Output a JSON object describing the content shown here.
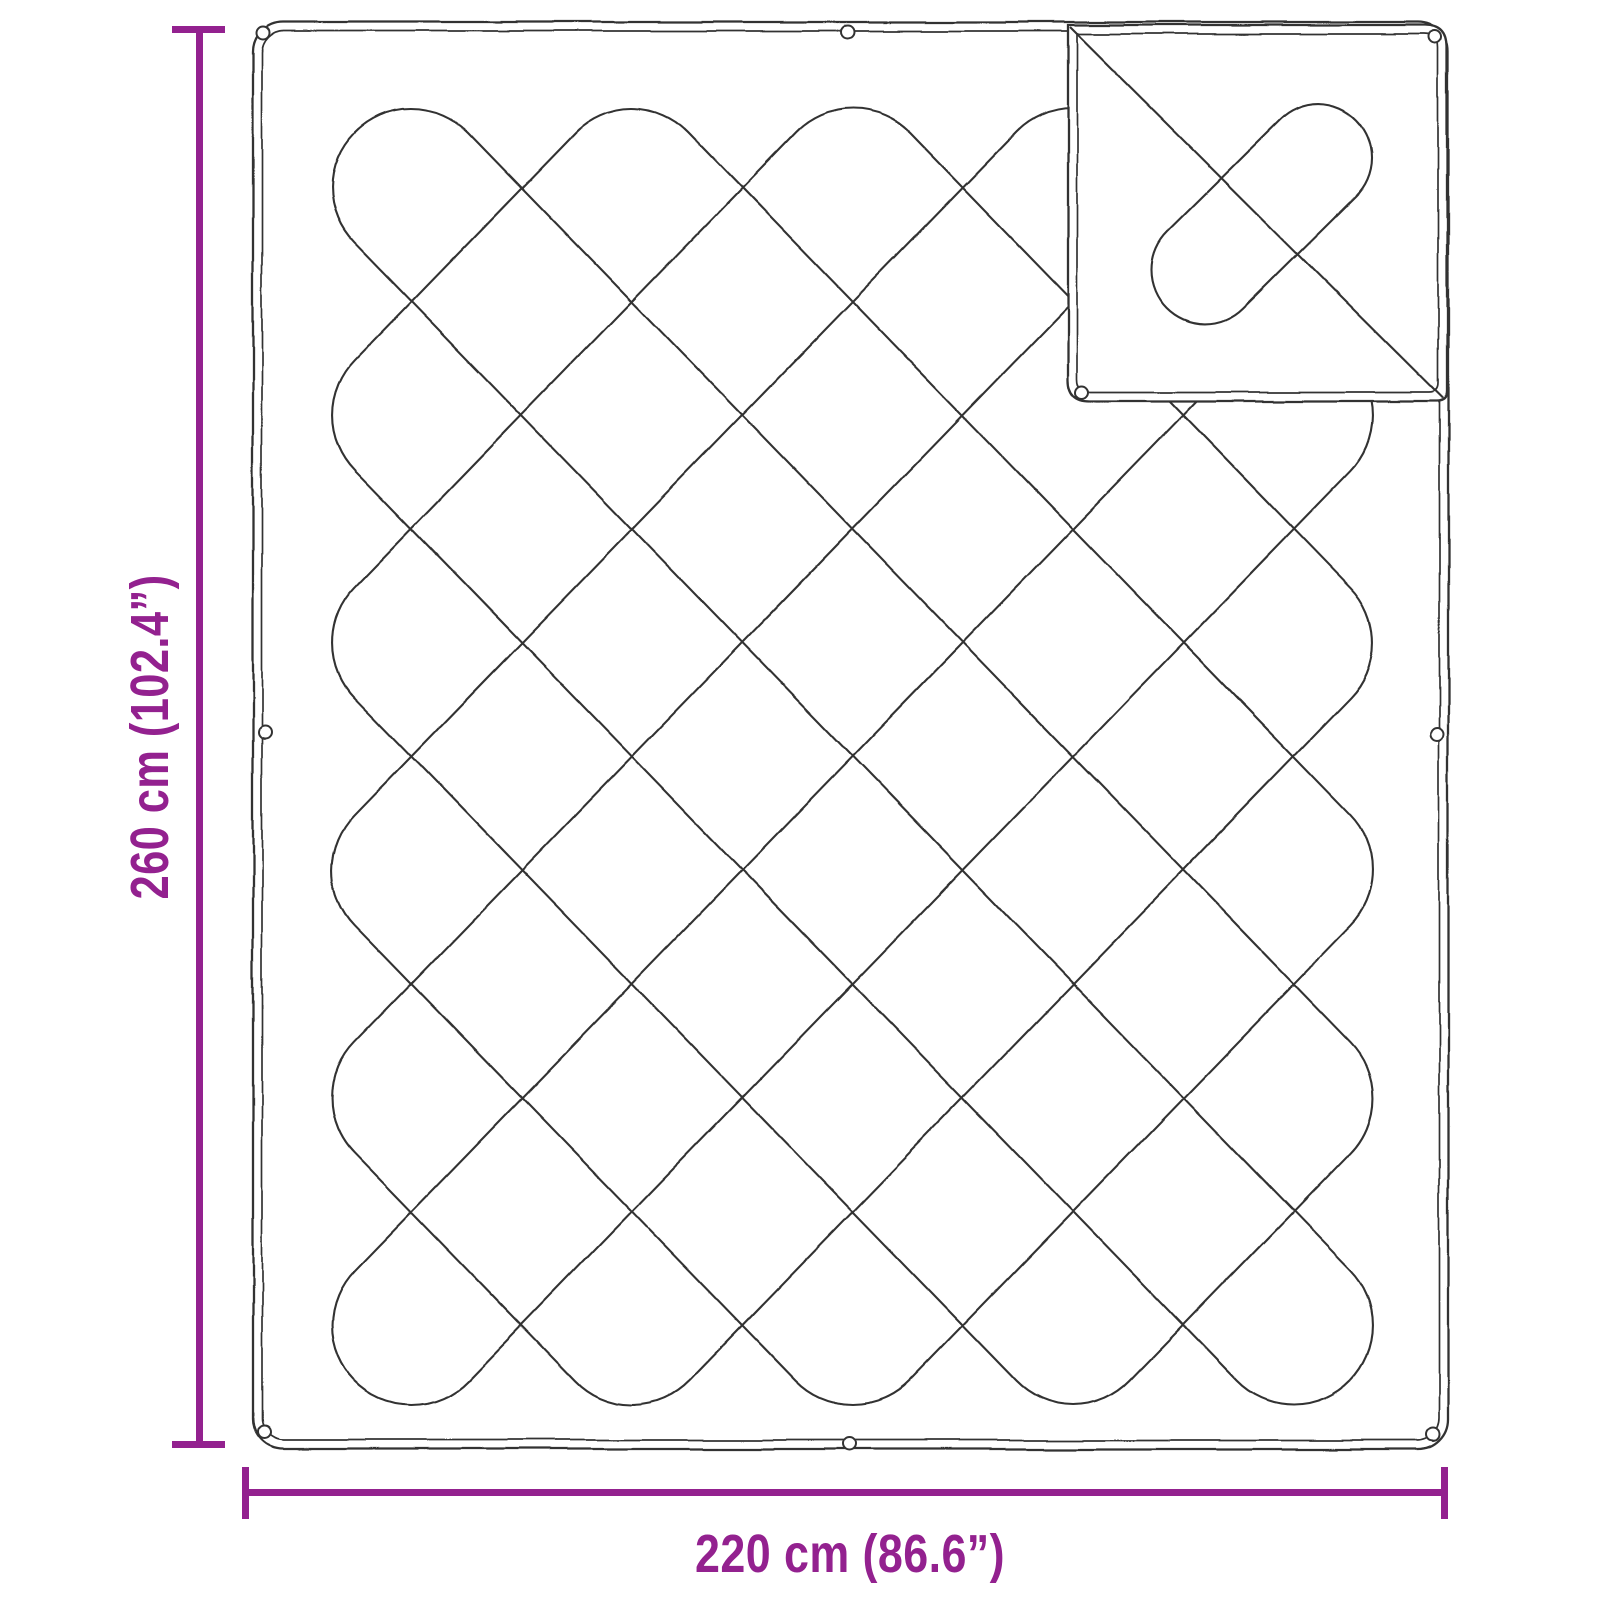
{
  "meta": {
    "subject": "Dimension diagram of a quilted blanket with folded-over corner"
  },
  "dimensions": {
    "height_label": "260 cm (102.4”)",
    "width_label": "220 cm (86.6”)"
  },
  "colors": {
    "accent": "#93218F",
    "line": "#333333",
    "background": "#FFFFFF"
  }
}
